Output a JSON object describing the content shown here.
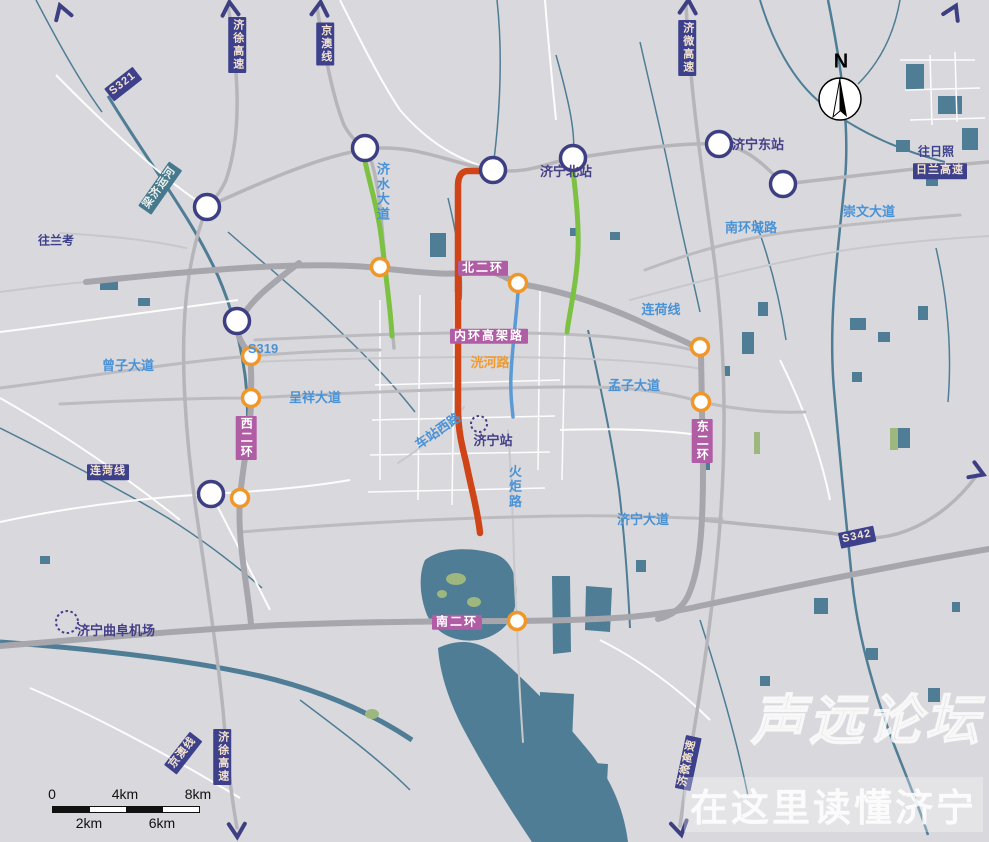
{
  "map": {
    "watermark": {
      "line1": "声远论坛",
      "line2": "在这里读懂济宁"
    },
    "compass": {
      "label": "N"
    },
    "scale_bar": {
      "top_labels": [
        "0",
        "4km",
        "8km"
      ],
      "bottom_labels": [
        "2km",
        "6km"
      ]
    },
    "colors": {
      "background": "#d9d9dd",
      "water": "#4e7d95",
      "navy": "#3d408a",
      "ring_badge": "#b05da5",
      "orange_node": "#ef9729",
      "red_line": "#cf4517",
      "green_line": "#7cc142",
      "blue_line": "#5b9bd5"
    },
    "badges": [
      {
        "text": "S321",
        "x": 123,
        "y": 84,
        "style": "expwy",
        "rot": -38
      },
      {
        "text": "济徐高速",
        "x": 237,
        "y": 45,
        "style": "expwy",
        "vertical": true
      },
      {
        "text": "京澳线",
        "x": 325,
        "y": 44,
        "style": "expwy",
        "vertical": true
      },
      {
        "text": "济微高速",
        "x": 687,
        "y": 48,
        "style": "expwy",
        "vertical": true
      },
      {
        "text": "日兰高速",
        "x": 940,
        "y": 171,
        "style": "expwy"
      },
      {
        "text": "S342",
        "x": 857,
        "y": 537,
        "style": "expwy",
        "rot": -12
      },
      {
        "text": "连菏线",
        "x": 108,
        "y": 472,
        "style": "expwy"
      },
      {
        "text": "济徐高速",
        "x": 222,
        "y": 757,
        "style": "expwy",
        "vertical": true
      },
      {
        "text": "京澳线",
        "x": 183,
        "y": 753,
        "style": "expwy",
        "rot": -52
      },
      {
        "text": "济微高速",
        "x": 688,
        "y": 763,
        "style": "expwy",
        "rot": -78
      },
      {
        "text": "北二环",
        "x": 483,
        "y": 268,
        "style": "ring"
      },
      {
        "text": "内环高架路",
        "x": 489,
        "y": 336,
        "style": "ring"
      },
      {
        "text": "西二环",
        "x": 246,
        "y": 438,
        "style": "ring",
        "vertical": true
      },
      {
        "text": "东二环",
        "x": 702,
        "y": 441,
        "style": "ring",
        "vertical": true
      },
      {
        "text": "南二环",
        "x": 457,
        "y": 622,
        "style": "ring"
      },
      {
        "text": "梁济运河",
        "x": 160,
        "y": 188,
        "style": "water",
        "rot": -55
      }
    ],
    "road_labels": [
      {
        "text": "济水大道",
        "x": 382,
        "y": 192,
        "color": "blue",
        "vertical": true
      },
      {
        "text": "S319",
        "x": 263,
        "y": 349,
        "color": "blue"
      },
      {
        "text": "曾子大道",
        "x": 128,
        "y": 366,
        "color": "blue"
      },
      {
        "text": "呈祥大道",
        "x": 315,
        "y": 398,
        "color": "blue"
      },
      {
        "text": "连荷线",
        "x": 661,
        "y": 310,
        "color": "blue"
      },
      {
        "text": "孟子大道",
        "x": 634,
        "y": 386,
        "color": "blue"
      },
      {
        "text": "车站西路",
        "x": 438,
        "y": 431,
        "color": "blue",
        "rot": -35
      },
      {
        "text": "火炬路",
        "x": 514,
        "y": 487,
        "color": "blue",
        "vertical": true
      },
      {
        "text": "济宁大道",
        "x": 643,
        "y": 520,
        "color": "blue"
      },
      {
        "text": "崇文大道",
        "x": 869,
        "y": 212,
        "color": "blue"
      },
      {
        "text": "南环城路",
        "x": 751,
        "y": 228,
        "color": "blue"
      },
      {
        "text": "洸河路",
        "x": 490,
        "y": 363,
        "color": "orange"
      },
      {
        "text": "往兰考",
        "x": 56,
        "y": 241,
        "color": "navy"
      },
      {
        "text": "往日照",
        "x": 936,
        "y": 152,
        "color": "navy"
      }
    ],
    "stations": [
      {
        "text": "济宁北站",
        "x": 566,
        "y": 172
      },
      {
        "text": "济宁东站",
        "x": 758,
        "y": 145
      },
      {
        "text": "济宁站",
        "x": 493,
        "y": 441
      },
      {
        "text": "济宁曲阜机场",
        "x": 116,
        "y": 631
      }
    ],
    "junctions": [
      {
        "x": 207,
        "y": 207
      },
      {
        "x": 365,
        "y": 148
      },
      {
        "x": 493,
        "y": 170
      },
      {
        "x": 573,
        "y": 158
      },
      {
        "x": 719,
        "y": 144
      },
      {
        "x": 783,
        "y": 184
      },
      {
        "x": 237,
        "y": 321
      },
      {
        "x": 211,
        "y": 494
      }
    ],
    "interchanges": [
      {
        "x": 380,
        "y": 267
      },
      {
        "x": 518,
        "y": 283
      },
      {
        "x": 251,
        "y": 356
      },
      {
        "x": 251,
        "y": 398
      },
      {
        "x": 240,
        "y": 498
      },
      {
        "x": 700,
        "y": 347
      },
      {
        "x": 701,
        "y": 402
      },
      {
        "x": 517,
        "y": 621
      }
    ],
    "dashed_markers": [
      {
        "x": 479,
        "y": 424,
        "r": 8
      },
      {
        "x": 67,
        "y": 622,
        "r": 11
      }
    ],
    "arrows": [
      {
        "x": 62,
        "y": 12,
        "rot": -18
      },
      {
        "x": 230,
        "y": 9,
        "rot": -5
      },
      {
        "x": 320,
        "y": 9,
        "rot": 5
      },
      {
        "x": 688,
        "y": 7,
        "rot": 3
      },
      {
        "x": 953,
        "y": 12,
        "rot": 25
      },
      {
        "x": 237,
        "y": 830,
        "rot": 178
      },
      {
        "x": 680,
        "y": 828,
        "rot": 168
      },
      {
        "x": 977,
        "y": 472,
        "rot": 112
      }
    ]
  }
}
